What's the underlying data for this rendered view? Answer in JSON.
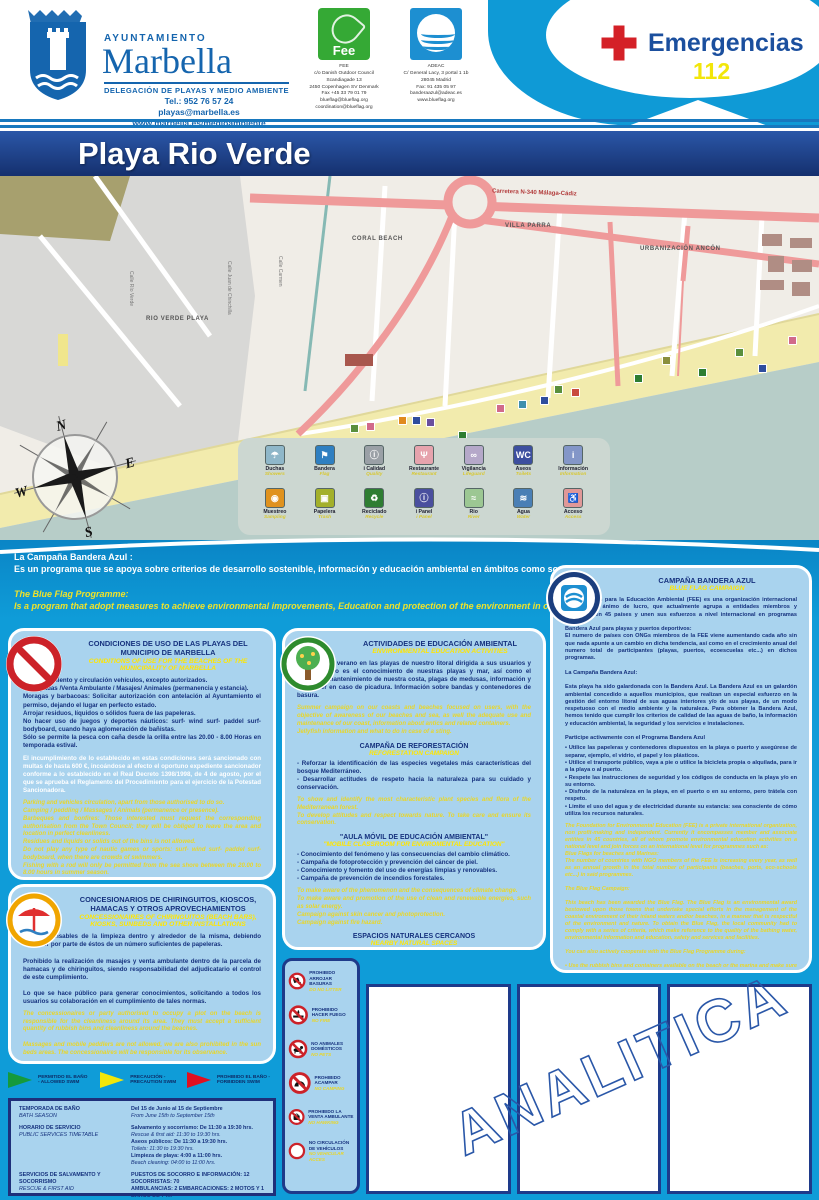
{
  "header": {
    "ayuntamiento": "AYUNTAMIENTO",
    "city": "Marbella",
    "delegation": "DELEGACIÓN DE PLAYAS Y MEDIO AMBIENTE",
    "tel": "Tel.: 952 76 57 24",
    "email": "playas@marbella.es",
    "web": "www.marbella.es/medioambiente",
    "fee_logo_text": "Fee",
    "fee_info": "FEE\nc/o Danish Outdoor Council\nScandiagade 13\n2450 Copenhagen SV Denmark\nFax +45 33 79 01 79\nblueflag@blueflag.org\ncoordination@blueflag.org",
    "adeac_info": "ADEAC\nC/ General Lacy, 3 portal 1 1b\n28045 Madrid\nFax: 91 435 05 97\nbanderaazul@adeac.es\nwww.blueflag.org",
    "emergency_label": "Emergencias",
    "emergency_number": "112"
  },
  "title": "Playa Rio Verde",
  "map_area": {
    "labels": {
      "villa_parra": "VILLA PARRA",
      "coral_beach": "CORAL BEACH",
      "urbanizacion": "URBANIZACIÓN ANCÓN",
      "rio_verde_playa": "RIO VERDE PLAYA",
      "road": "Carretera N-340 Málaga-Cádiz",
      "calle_rio_verde": "Calle Río Verde",
      "calle_juan": "Calle Juan de Chinchilla",
      "calle_carmen": "Calle Carmen"
    },
    "compass": {
      "n": "N",
      "e": "E",
      "s": "S",
      "w": "W"
    },
    "markers": [
      {
        "x": 330,
        "y": 290,
        "c": "#2e4d9e"
      },
      {
        "x": 350,
        "y": 248,
        "c": "#5a8f3c"
      },
      {
        "x": 366,
        "y": 246,
        "c": "#d16a8a"
      },
      {
        "x": 382,
        "y": 266,
        "c": "#3f8fae"
      },
      {
        "x": 398,
        "y": 240,
        "c": "#e08a1e"
      },
      {
        "x": 412,
        "y": 240,
        "c": "#2e4d9e"
      },
      {
        "x": 426,
        "y": 242,
        "c": "#6a4f9e"
      },
      {
        "x": 458,
        "y": 255,
        "c": "#2e7d32"
      },
      {
        "x": 496,
        "y": 228,
        "c": "#d16a8a"
      },
      {
        "x": 518,
        "y": 224,
        "c": "#3f8fae"
      },
      {
        "x": 540,
        "y": 220,
        "c": "#2e4d9e"
      },
      {
        "x": 554,
        "y": 209,
        "c": "#5a8f3c"
      },
      {
        "x": 571,
        "y": 212,
        "c": "#c94a3f"
      },
      {
        "x": 634,
        "y": 198,
        "c": "#2e7d32"
      },
      {
        "x": 662,
        "y": 180,
        "c": "#8a8f3c"
      },
      {
        "x": 698,
        "y": 192,
        "c": "#2e7d32"
      },
      {
        "x": 735,
        "y": 172,
        "c": "#5a8f3c"
      },
      {
        "x": 758,
        "y": 188,
        "c": "#2e4d9e"
      },
      {
        "x": 788,
        "y": 160,
        "c": "#d16a8a"
      }
    ]
  },
  "legend": {
    "items": [
      {
        "es": "Duchas",
        "en": "Showers",
        "bg": "#8fb7c9",
        "glyph": "☂"
      },
      {
        "es": "Bandera",
        "en": "Flag",
        "bg": "#2f7fc1",
        "glyph": "⚑"
      },
      {
        "es": "i Calidad",
        "en": "Quality",
        "bg": "#9aa0a6",
        "glyph": "ⓘ"
      },
      {
        "es": "Restaurante",
        "en": "Restaurant",
        "bg": "#e6a3ad",
        "glyph": "Ψ"
      },
      {
        "es": "Vigilancia",
        "en": "Lifeguard",
        "bg": "#b5a8c9",
        "glyph": "∞"
      },
      {
        "es": "Aseos",
        "en": "Toilets",
        "bg": "#3d4f9f",
        "glyph": "WC"
      },
      {
        "es": "Información",
        "en": "Information",
        "bg": "#8396c8",
        "glyph": "i"
      },
      {
        "es": "Muestreo",
        "en": "Sampling",
        "bg": "#e0921e",
        "glyph": "◉"
      },
      {
        "es": "Papelera",
        "en": "Trash",
        "bg": "#a3b02a",
        "glyph": "▣"
      },
      {
        "es": "Reciclado",
        "en": "Recycle",
        "bg": "#2e7d32",
        "glyph": "♻"
      },
      {
        "es": "i Panel",
        "en": "i Panel",
        "bg": "#4a4f9e",
        "glyph": "ⓘ"
      },
      {
        "es": "Rio",
        "en": "River",
        "bg": "#9cc793",
        "glyph": "≈"
      },
      {
        "es": "Agua",
        "en": "Water",
        "bg": "#4a7fb5",
        "glyph": "≋"
      },
      {
        "es": "Acceso",
        "en": "Access",
        "bg": "#e09898",
        "glyph": "♿"
      }
    ]
  },
  "intro": {
    "es_title": "La Campaña Bandera Azul :",
    "es_body": "Es un programa que se apoya sobre criterios de desarrollo sostenible, información y educación ambiental en ámbitos como son las playas.",
    "en_title": "The Blue Flag Programme:",
    "en_body": "Is a program that adopt measures to achieve environmental improvements, Education and protection of the environment in our Beaches."
  },
  "panels": {
    "condiciones": {
      "title": "CONDICIONES DE USO DE LAS PLAYAS DEL MUNICIPIO DE MARBELLA",
      "title_en": "CONDITIONS OF USE FOR THE BEACHES OF THE MUNICIPALITY OF MARBELLA",
      "body": "Estacionamiento y circulación vehículos, excepto autorizados.\nAcampadas /Venta Ambulante / Masajes/ Animales (permanencia y estancia).\nMoragas y barbacoas: Solicitar autorización con antelación al Ayuntamiento el permiso, dejando el lugar en perfecto estado.\nArrojar residuos, líquidos o sólidos fuera de las papeleras.\nNo hacer uso de juegos y deportes náuticos: surf- wind surf- paddel surf- bodyboard, cuando haya aglomeración de bañistas.\nSólo se permite la pesca con caña desde la orilla entre las 20.00 - 8.00 Horas en temporada estival.",
      "sanction": "El incumplimiento de lo establecido en estas condiciones será sancionado con multas de hasta 600 €, incoándose al efecto el oportuno expediente sancionador conforme a lo establecido en el Real Decreto 1398/1998, de 4 de agosto, por el que se aprueba el Reglamento del Procedimiento para el ejercicio de la Potestad Sancionadora.",
      "body_en": "Parking and vehicles circulation, apart from those authorised to do so.\nCamping / peddling / Massages / Animals (permanence or presence).\nBarbeques and bonfires: Those interested must request the corresponding authorisation from the Town Council; they will be obliged to leave the area and location in perfect cleanliness.\nResidues and liquids or solids out of the bins is not allowed.\nDo not play any type of nautic games or sports: surf- wind surf- paddel surf- bodyboard, when there are crowds of swimmers.\nFishing with a rod will only be permitted from the sea shore between the 20.00 to 8.00 hours in summer season.",
      "sanction_en": "All these rules must be followed. Those who break these rules will fall onto fines up to 600 €, according with the sanction procedures (Royal Decree 1398/1998, of 4th of August, by which the legal authorities on sanctioning was approved)."
    },
    "actividades": {
      "title": "ACTIVIDADES DE EDUCACIÓN AMBIENTAL",
      "title_en": "ENVIRONMENTAL EDUCATION ACTIVITIES",
      "intro_es": "Campaña de verano en las playas de nuestro litoral dirigida a sus usuarios y cuyo objetivo es el conocimiento de nuestras playas y mar, así como el adecuado mantenimiento de nuestra costa, plagas de medusas, información y que hacer en caso de picadura. Información sobre bandas y contenedores de basura.",
      "intro_en": "Summer campaign on our coasts and beaches focused on users, with the objective of awareness of our beaches and sea, as well the adequate use and maintenance of our coast, information about antics and related containers.\nJellyfish information and what to do in case of a sting.",
      "reforest_title": "CAMPAÑA DE REFORESTACIÓN",
      "reforest_sub": "REFORESTATION CAMPAIGN",
      "reforest_es": "- Reforzar la identificación de las especies vegetales más características del bosque Mediterráneo.\n- Desarrollar actitudes de respeto hacia la naturaleza para su cuidado y conservación.",
      "reforest_en": "To show and identify the most characteristic plant species and flora of the Mediterranean forest.\nTo develop attitudes and respect towards nature. To take care and ensure its conservation.",
      "aula_title": "\"AULA MÓVIL DE EDUCACIÓN AMBIENTAL\"",
      "aula_sub": "\"MOBILE CLASSROOM FOR ENVIROMENTAL EDUCATION\"",
      "aula_es": "- Conocimiento del fenómeno y las consecuencias del cambio climático.\n- Campaña de fotoprotección y prevención del cáncer de piel.\n- Conocimiento y fomento del uso de energías limpias y renovables.\n- Campaña de prevención de incendios forestales.",
      "aula_en": "To make aware of the phenomenon and the consequences of climate change.\nTo make aware and promotion of the use of clean and renewable energies, such as solar energy.\nCampaign against skin cancer and photoprotection.\nCampaign against fire hazard.",
      "espacios_title": "ESPACIOS NATURALES CERCANOS",
      "espacios_sub": "NEARBY NATURAL SPACES",
      "espacios_es": "• Parque Natural Sierra de las Nieves • Monumento Natural Dunas de Artola-Cabopino • Espacio Natural Sierra Blanca • Alcornocales de Elviria • En su entorno se encuentran situadas las Bóvedas, ruinas históricas del siglo III."
    },
    "bandera": {
      "title": "CAMPAÑA BANDERA AZUL",
      "title_en": "BLUE FLAG CAMPAIGN",
      "body_es": "La Fundación para la Educación Ambiental (FEE) es una organización internacional privada, sin ánimo de lucro, que actualmente agrupa a entidades miembros y asociados en 45 países y unen sus esfuerzos a nivel internacional en programas como:\nBandera Azul para playas y puertos deportivos:\nEl numero de países con ONGs miembros de la FEE viene aumentando cada año sin que nada apunte a un cambio en dicha tendencia, así como en el crecimiento anual del numero total de participantes (playas, puertos, ecoescuelas etc...) en dichos programas.\n\nLa Campaña Bandera Azul:\n\nEsta playa ha sido galardonada con la Bandera Azul. La Bandera Azul es un galardón ambiental concedido a aquellos municipios, que realizan un especial esfuerzo en la gestión del entorno litoral de sus aguas interiores y/o de sus playas, de un modo respetuoso con el medio ambiente y la naturaleza. Para obtener la Bandera Azul, hemos tenido que cumplir los criterios de calidad de las aguas de baño, la información y educación ambiental, la seguridad y los servicios e instalaciones.\n\nParticipe activamente con el Programa Bandera Azul",
      "bullets_es": "• Utilice las papeleras y contenedores dispuestos en la playa o puerto y asegúrese de separar, ejemplo, el vidrio, el papel y los plásticos.\n• Utilice el transporte público, vaya a pie o utilice la bicicleta propia o alquilada, para ir a la playa o al puerto.\n• Respete las instrucciones de seguridad y los códigos de conducta en la playa y/o en su entorno.\n• Disfrute de la naturaleza en la playa, en el puerto o en su entorno, pero trátela con respeto.\n• Limite el uso del agua y de electricidad durante su estancia: sea consciente de cómo utiliza los recursos naturales.",
      "body_en": "The Foundation for Environmental Education (FEE) is a private international organization, non profit-making and independent. Currently it encompasses member and associate entities in 45 countries, all of whom promote environmental education activities on a national level and join forces on an international level for programmes such as:\nBlue Flags for beaches and Marinas:\nThe number of countries with NGO members of the FEE is increasing every year, as well as an annual growth in the total number of participants (beaches, ports, eco-schools etc...) in said programmes.\n\nThe Blue Flag Campaign:\n\nThis beach has been awarded the Blue Flag. The Blue Flag is an environmental award bestowed upon those towns that undertake special efforts in the management of the coastal environment of their inland waters and/or beaches, in a manner that is respectful of the environment and nature. To obtain the Blue Flag, the local community had to comply with a series of criteria, which make reference to the quality of the bathing water, environmental information and education, safety and services and facilities.\n\nYou can also actively cooperate with the Blue Flag Programme during:\n\n• Use the rubbish bins and containers available on the beach or the marina and make sure you separate where possible, for example, glass, paper and plastic.\n• If possible, transport, walk or use your own or a rented bicycle to go to the beach or the marina.\n• Respect the safety instructions and codes of conduct for the beach and its surroundings.\n• Enjoy nature on the beach, the marina or in your surroundings, but treat it with respect.\n• Limit your use of water and electricity during your stay. Be aware of how you make use of natural resources."
    },
    "concesionarios": {
      "title": "CONCESIONARIOS DE CHIRINGUITOS, KIOSCOS, HAMACAS Y OTROS APROVECHAMIENTOS",
      "title_en": "CONCESSIONAIRES OF CHIRINGUITOS (BEACH BARS), KIOSKS, SUNBEDS AND OTHER INSTALLATIONS",
      "body_es": "Son responsables de la limpieza dentro y alrededor de la misma, debiendo disponer por parte de éstos de un número suficientes de papeleras.\n\nProhibido la realización de masajes y venta ambulante dentro de la parcela de hamacas y de chiringuitos, siendo responsabilidad del adjudicatario el control de este cumplimiento.\n\nLo que se hace público para generar conocimientos, solicitando a todos los usuarios su colaboración en el cumplimiento de tales normas.",
      "body_en": "The concessionaires or party authorised to occupy a plot on the beach is responsible for the cleanliness around its area. They must accept a sufficient quantity of rubbish bins and cleanliness around the beaches.\n\nMassages and mobile peddlers are not allowed, we are also prohibited in the sun beds areas. The concessionaires will be responsible for its observance.\n\nThese rules are publicized to generate awareness, all users and beach goers are kindly requested to follow these rules and regulations."
    }
  },
  "prohibitions": {
    "items": [
      {
        "es": "PROHIBIDO ARROJAR BASURAS",
        "en": "DO NO LITTER"
      },
      {
        "es": "PROHIBIDO HACER FUEGO",
        "en": "NO FIRE"
      },
      {
        "es": "NO ANIMALES DOMÉSTICOS",
        "en": "NO PETS"
      },
      {
        "es": "PROHIBIDO ACAMPAR",
        "en": "NO CAMPING"
      },
      {
        "es": "PROHIBIDO LA VENTA AMBULANTE",
        "en": "NO HAWKING"
      },
      {
        "es": "NO CIRCULACIÓN DE VEHÍCULOS",
        "en": "NO VEHICULAR ACCES"
      }
    ]
  },
  "flags": {
    "items": [
      {
        "label": "PERMITIDO EL BAÑO - ALLOWED SWIM",
        "color": "#159a3c"
      },
      {
        "label": "PRECAUCIÓN - PRECAUTION SWIM",
        "color": "#f2e60a"
      },
      {
        "label": "PROHIBIDO EL BAÑO - FORBIDDEN SWIM",
        "color": "#e01020"
      }
    ]
  },
  "schedule": {
    "rows": [
      {
        "label": "TEMPORADA DE BAÑO",
        "label_en": "BATH SEASON",
        "lines": [
          "Del 15 de Junio al 15 de Septiembre",
          "From June 15th to September 15th"
        ]
      },
      {
        "label": "HORARIO DE SERVICIO",
        "label_en": "PUBLIC SERVICES TIMETABLE",
        "lines": [
          "Salvamento y socorrismo: De 11:30 a 19:30 hrs.",
          "Rescue & first aid: 11:30 to 19:30 hrs.",
          "Aseos públicos: De 11:30 a 19:30 hrs.",
          "Toilets: 11:30 to 19:30 hrs.",
          "Limpieza de playa: 4:00 a 11:00 hrs.",
          "Beach cleaning: 04:00 to 11:00 hrs."
        ]
      },
      {
        "label": "SERVICIOS DE SALVAMENTO Y SOCORRISMO",
        "label_en": "RESCUE & FIRST AID",
        "lines": [
          "PUESTOS DE SOCORRO E INFORMACIÓN: 12",
          "SOCORRISTAS: 70",
          "AMBULANCIAS: 2 EMBARCACIONES: 2 MOTOS Y 1 BARCO DE 7 m."
        ]
      }
    ]
  },
  "watermark": "ANALITICA"
}
